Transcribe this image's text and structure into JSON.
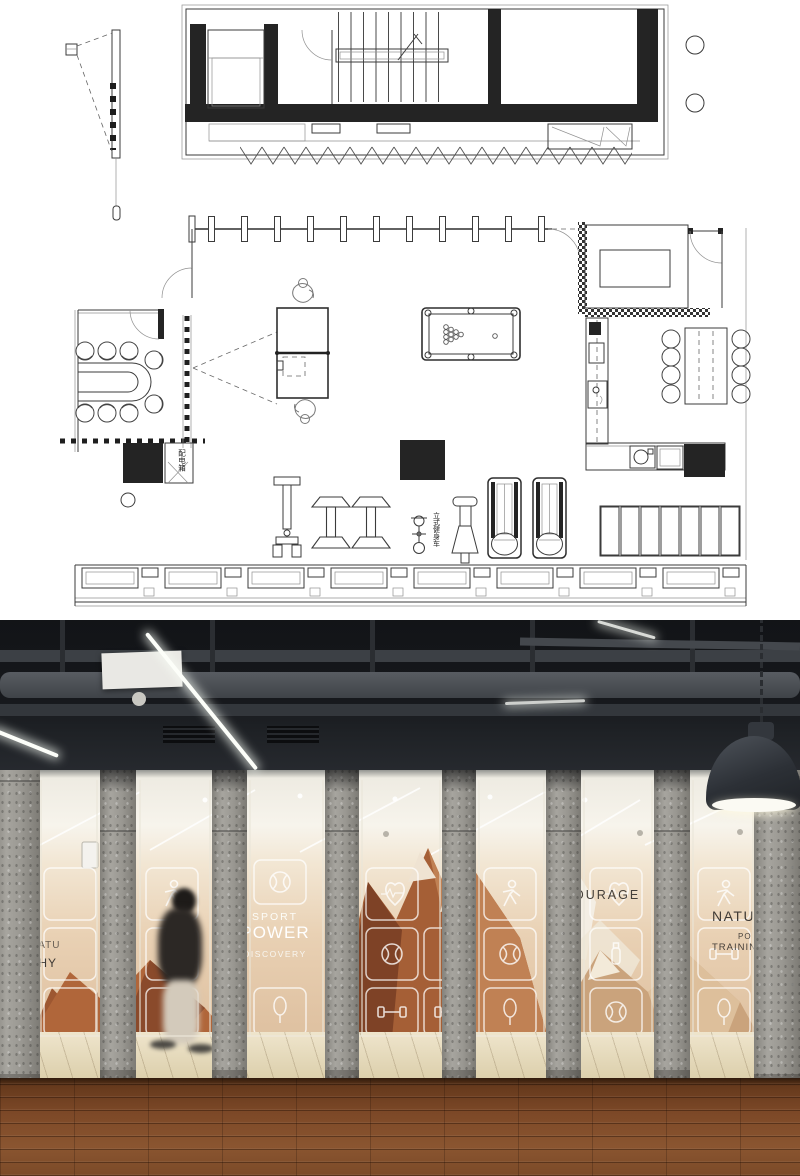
{
  "floor_plan": {
    "labels": {
      "distribution_box": "配电箱",
      "upright_bike": "立式健身车"
    }
  },
  "photo": {
    "glass_texts": {
      "left_line1": "NATU",
      "left_line2": "THY",
      "sport": "SPORT",
      "power": "POWER",
      "discovery": "DISCOVERY",
      "courage": "COURAGE",
      "nature": "NATU",
      "po": "PO",
      "training": "TRAINING"
    },
    "colors": {
      "mural_copper": "#a55f36",
      "mural_dark": "#7e4226",
      "mural_light": "#caa37c",
      "concrete_gray": "#97958f",
      "wood_floor": "#7c4827",
      "ceiling_black": "#17191c",
      "led_white": "#fcfef9",
      "exit_sign_green": "#2f9e5d"
    }
  }
}
